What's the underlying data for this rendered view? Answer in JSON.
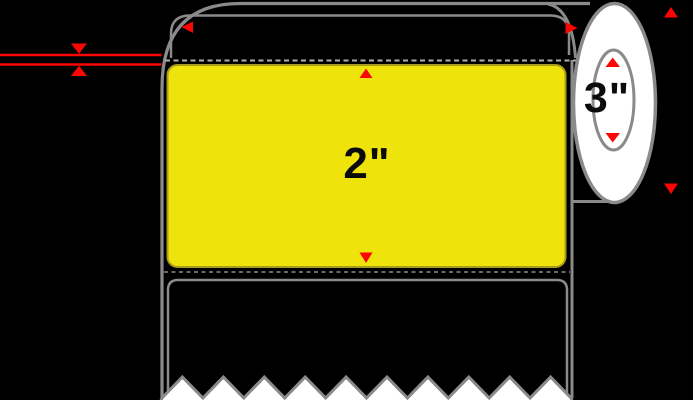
{
  "diagram": {
    "label": {
      "height_text": "2\""
    },
    "core": {
      "diameter_text": "3\""
    },
    "colors": {
      "background": "#000000",
      "outline_gray": "#8A8A8A",
      "dash_gray": "#B0B0B0",
      "label_yellow": "#EEE30A",
      "label_border_olive": "#A89B1E",
      "dimension_red": "#FB0505",
      "face_white": "#FFFFFF",
      "text_black": "#0B0B0B"
    }
  }
}
